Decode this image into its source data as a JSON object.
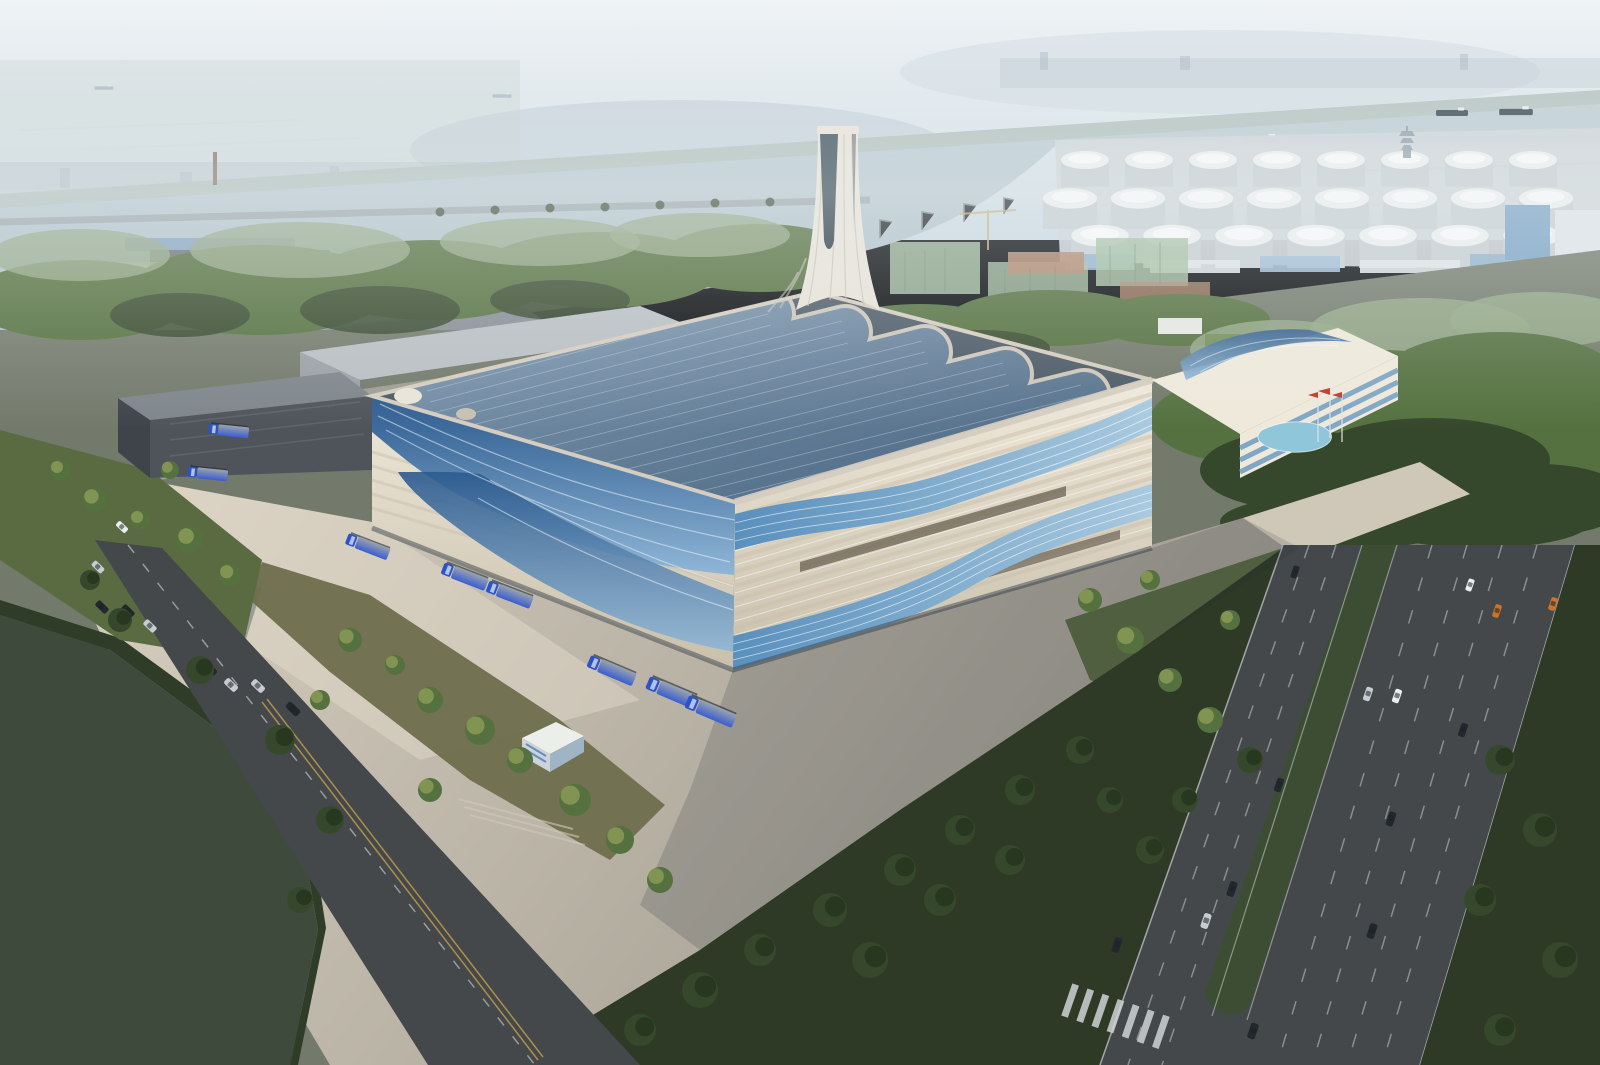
{
  "scene": {
    "description": "Aerial architectural rendering of a waste-to-energy plant with a solar-panel roof, flowing blue ribbon facades and a sculptural chimney, set in a riverside industrial port district",
    "signboard_text": "东莞丰业",
    "objects": {
      "blue_trucks": 8,
      "cars_on_left_road": 9,
      "cars_on_boulevard": 15,
      "cargo_ships_on_river": 3,
      "flagpoles": 3
    },
    "palette": {
      "sky_top": "#eff3f5",
      "sky_low": "#cbdae2",
      "hill": "#b5c2cf",
      "city": "#a9b6c1",
      "marsh": "#c6d2cc",
      "bridge": "#8494a3",
      "water_hi": "#c1d0d5",
      "water_lo": "#a7bcc4",
      "far_shore": "#aebbae",
      "tank": "#edf0f0",
      "tank_shade": "#c6cfd3",
      "dock": "#b7bdbf",
      "crane": "#6f7a82",
      "tree_mid": "#55713f",
      "tree_dark": "#36482c",
      "tree_lit": "#8a9a56",
      "tree_haze": "#93a886",
      "beige_bldg": "#d8d1bf",
      "grey_bldg": "#b6bcc0",
      "metal_shed": "#868e95",
      "dark_annex": "#4f545b",
      "mesh_green": "#a3bfa0",
      "brick": "#b3876b",
      "roof_deck": "#4c5a66",
      "solar_hi": "#7e98b0",
      "solar_lo": "#45607b",
      "panel_frame": "#d5cdbf",
      "glass_hi": "#8fb6d6",
      "glass_lo": "#2c5a8e",
      "cream_hi": "#efe9db",
      "cream_lo": "#c9bfab",
      "ribbon_hi": "#a9cadf",
      "ribbon_lo": "#5a90bd",
      "slot_dark": "#6b6153",
      "chimney": "#e9e4d9",
      "chimney_shade": "#c8c1b2",
      "chimney_glass": "#2c3b45",
      "plaza_sun": "#d8d0c0",
      "plaza_shade": "#a09b90",
      "concrete": "#a5a59b",
      "shadow": "#232b3a",
      "road": "#45484b",
      "lane": "#ced3d5",
      "lane_yellow": "#c3a14a",
      "lawn": "#5a6b42",
      "lawn_dark": "#2e3a26",
      "grass_olive": "#6e6e4d",
      "pond_dark": "#3d4a3c",
      "pond_site": "#8fc6da",
      "truck_grey": "#9aa4ae",
      "cab_blue": "#2d52c8",
      "flag_red": "#c03a2d",
      "car_silver": "#c6ccd1",
      "car_dark": "#23282e",
      "car_white": "#eaeef0",
      "car_orange": "#c9742a",
      "ship_dark": "#3c4c58",
      "ship_faint": "#8aa0ac",
      "white": "#ffffff"
    }
  }
}
